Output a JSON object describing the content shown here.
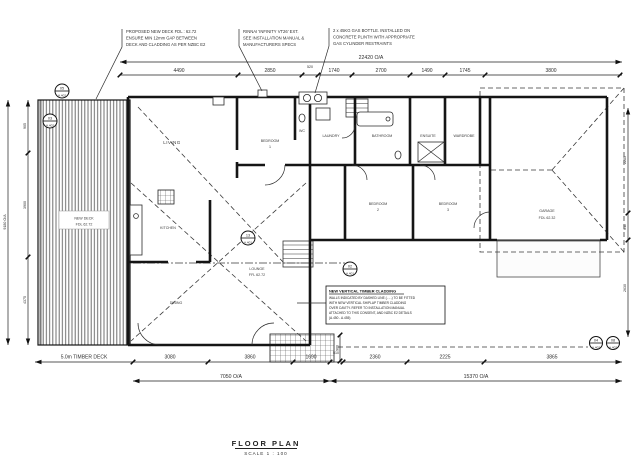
{
  "colors": {
    "paper": "#ffffff",
    "line": "#151515",
    "text": "#2e2e2e"
  },
  "title_block": {
    "title": "FLOOR PLAN",
    "scale": "SCALE 1 : 100"
  },
  "notes": [
    {
      "lines": [
        "PROPOSED NEW DECK FDL : 62.72",
        "ENSURE MIN 12mm GAP BETWEEN",
        "DECK AND CLADDING AS PER NZBC E2"
      ]
    },
    {
      "lines": [
        "RINNAI 'INFINITY VT26' EXT.",
        "SEE INSTALLATION MANUAL &",
        "MANUFACTURERS SPECS"
      ]
    },
    {
      "lines": [
        "2 x 45KG GAS BOTTLE. INSTALLED ON",
        "CONCRETE PLINTH WITH APPROPRIATE",
        "GAS CYLINDER RESTRAINTS"
      ]
    }
  ],
  "cladding_note": {
    "title": "NEW VERTICAL TIMBER CLADDING",
    "lines": [
      "WALLS INDICATED BY DASHED LINE (- - -) TO BE FITTED",
      "WITH NEW VERTICAL SHIPLAP TIMBER CLADDING",
      "OVER CAVITY. REFER TO INSTALLATION MANUAL",
      "ATTACHED TO THIS CONSENT, AND NZBC E2 DETAILS",
      "(A.450 - A.455)"
    ]
  },
  "rooms": {
    "living": "LIVING",
    "bedroom1": [
      "BEDROOM",
      "1"
    ],
    "wc": "WC",
    "laundry": "LAUNDRY",
    "bathroom": "BATHROOM",
    "ensuite": "ENSUITE",
    "wardrobe": "WARDROBE",
    "kitchen": "KITCHEN",
    "bedroom2": [
      "BEDROOM",
      "2"
    ],
    "bedroom3": [
      "BEDROOM",
      "3"
    ],
    "garage": [
      "GARAGE",
      "FDL 62.32"
    ],
    "lounge": [
      "LOUNGE",
      "FFL 62.72"
    ],
    "dining": "DINING",
    "deck": [
      "NEW DECK",
      "FDL 62.72"
    ]
  },
  "dims": {
    "top_overall": "22420 O/A",
    "top": [
      "4490",
      "2850",
      "520",
      "1740",
      "2700",
      "1490",
      "1745",
      "3800"
    ],
    "bottom_deck": "5.0m TIMBER DECK",
    "bottom": [
      "3080",
      "3860",
      "1690",
      "510",
      "2360",
      "2225",
      "3865"
    ],
    "bottom_oa_left": "7050 O/A",
    "bottom_oa_right": "15370 O/A",
    "left": [
      "905",
      "3900",
      "4375"
    ],
    "left_overall": "9180 O/A",
    "right": [
      "2285",
      "611",
      "2630"
    ],
    "stair": "900"
  },
  "markers": [
    {
      "num": "05",
      "sheet": "A.402"
    },
    {
      "num": "03",
      "sheet": "A.402"
    },
    {
      "num": "13",
      "sheet": "A.401"
    },
    {
      "num": "02",
      "sheet": "A.401"
    },
    {
      "num": "04",
      "sheet": "A.402"
    },
    {
      "num": "08",
      "sheet": "A.402"
    }
  ]
}
